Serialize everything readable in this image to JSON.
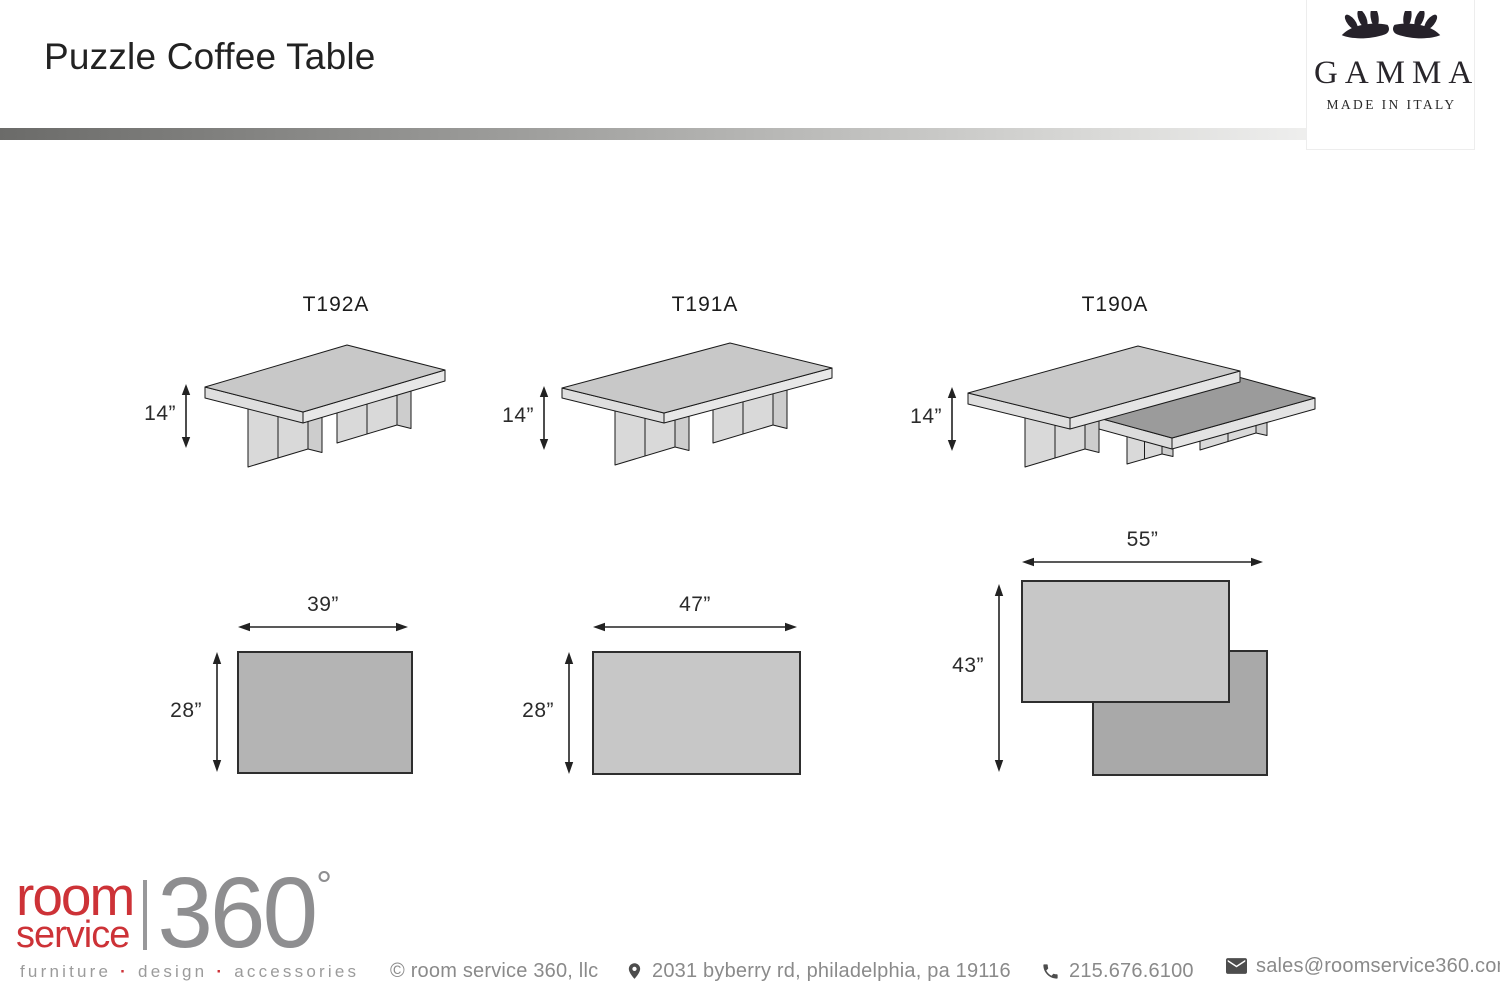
{
  "page": {
    "title": "Puzzle Coffee Table"
  },
  "brand": {
    "name": "GAMMA",
    "origin": "MADE IN ITALY"
  },
  "models": [
    {
      "code": "T192A",
      "height": "14”",
      "width": "39”",
      "depth": "28”"
    },
    {
      "code": "T191A",
      "height": "14”",
      "width": "47”",
      "depth": "28”"
    },
    {
      "code": "T190A",
      "height": "14”",
      "width": "55”",
      "depth": "43”"
    }
  ],
  "footer": {
    "logo": {
      "word1": "room",
      "word2": "service",
      "number": "360",
      "degree": "°"
    },
    "tagline": {
      "word1": "furniture",
      "word2": "design",
      "word3": "accessories",
      "separator": "·"
    },
    "copyright": "© room service 360, llc",
    "address": "2031 byberry rd, philadelphia, pa 19116",
    "phone": "215.676.6100",
    "email": "sales@roomservice360.com"
  },
  "colors": {
    "brand_red": "#cd3237",
    "logo_gray": "#8e8e90",
    "divider_start": "#6b6b69",
    "drawing_outline": "#1a1a1a",
    "footer_text": "#8a8a8a",
    "plan_fill_dark": "#a9a9a9",
    "plan_fill_light": "#c7c7c7"
  }
}
